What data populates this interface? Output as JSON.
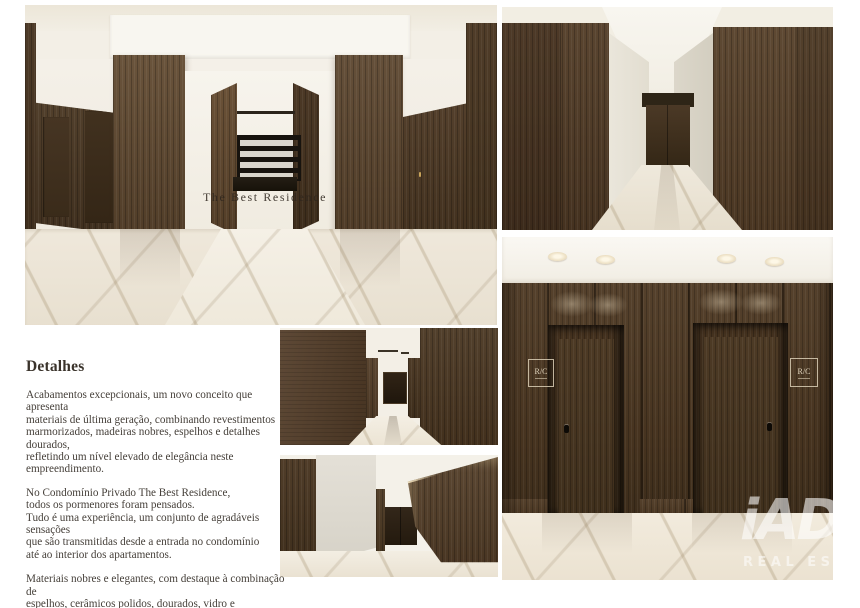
{
  "details": {
    "heading": "Detalhes",
    "paragraphs": [
      "Acabamentos excepcionais, um novo conceito que apresenta\nmateriais de última geração, combinando revestimentos\nmarmorizados, madeiras nobres, espelhos e detalhes dourados,\nrefletindo um nível elevado de elegância neste empreendimento.",
      "No Condomínio Privado The Best Residence,\ntodos os pormenores foram pensados.\nTudo é uma experiência, um conjunto de agradáveis sensações\nque são transmitidas desde a entrada no condomínio\naté ao interior dos apartamentos.",
      "Materiais nobres e elegantes, com destaque à combinação de\nespelhos, cerâmicos polidos, dourados, vidro e marmoreados."
    ]
  },
  "images": {
    "lobby": {
      "wall_text": "The Best Residence"
    },
    "elevators": {
      "sign_text": "R/C"
    }
  },
  "watermark": {
    "brand": "iAD",
    "tagline": "REAL ESTATE"
  },
  "colors": {
    "page_bg": "#ffffff",
    "wood_dark": "#44321e",
    "wood_mid": "#57432e",
    "marble": "#ece5d8",
    "ceiling_cream": "#efe9db",
    "body_text": "#46403a",
    "watermark_white": "rgba(255,255,255,0.58)"
  }
}
